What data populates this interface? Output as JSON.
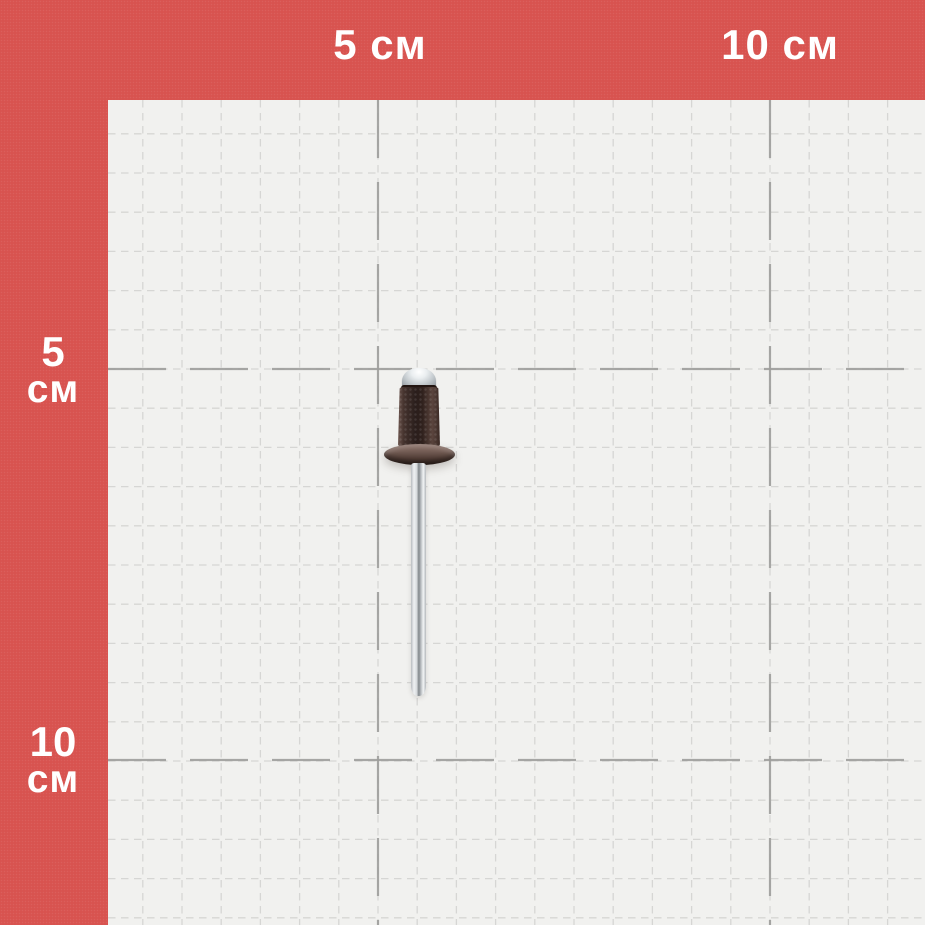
{
  "subject": {
    "type": "blind rivet",
    "body_color_name": "brown"
  },
  "ruler": {
    "frame_color": "#d8534f",
    "text_color": "#ffffff",
    "unit": "см",
    "top_labels": [
      {
        "text": "5 см",
        "x_px": 380
      },
      {
        "text": "10 см",
        "x_px": 780
      }
    ],
    "left_labels": [
      {
        "value": "5",
        "unit": "см",
        "y_px": 370
      },
      {
        "value": "10",
        "unit": "см",
        "y_px": 760
      }
    ]
  },
  "grid": {
    "background": "#f1f1ef",
    "minor_color": "#d6d6d4",
    "major_color": "#9e9e9c",
    "minor_spacing_px": 39.2,
    "px_per_cm": 78.4,
    "frame_top_px": 100,
    "frame_left_px": 108,
    "major_x_px": [
      378,
      770
    ],
    "major_y_px": [
      369,
      760
    ],
    "canvas_px": 925
  },
  "rivet_colors": {
    "mandrel_head": "#d9dde0",
    "body": "#3a2a26",
    "flange": "#5e4a43",
    "mandrel_pin": "#cfd3d6"
  }
}
